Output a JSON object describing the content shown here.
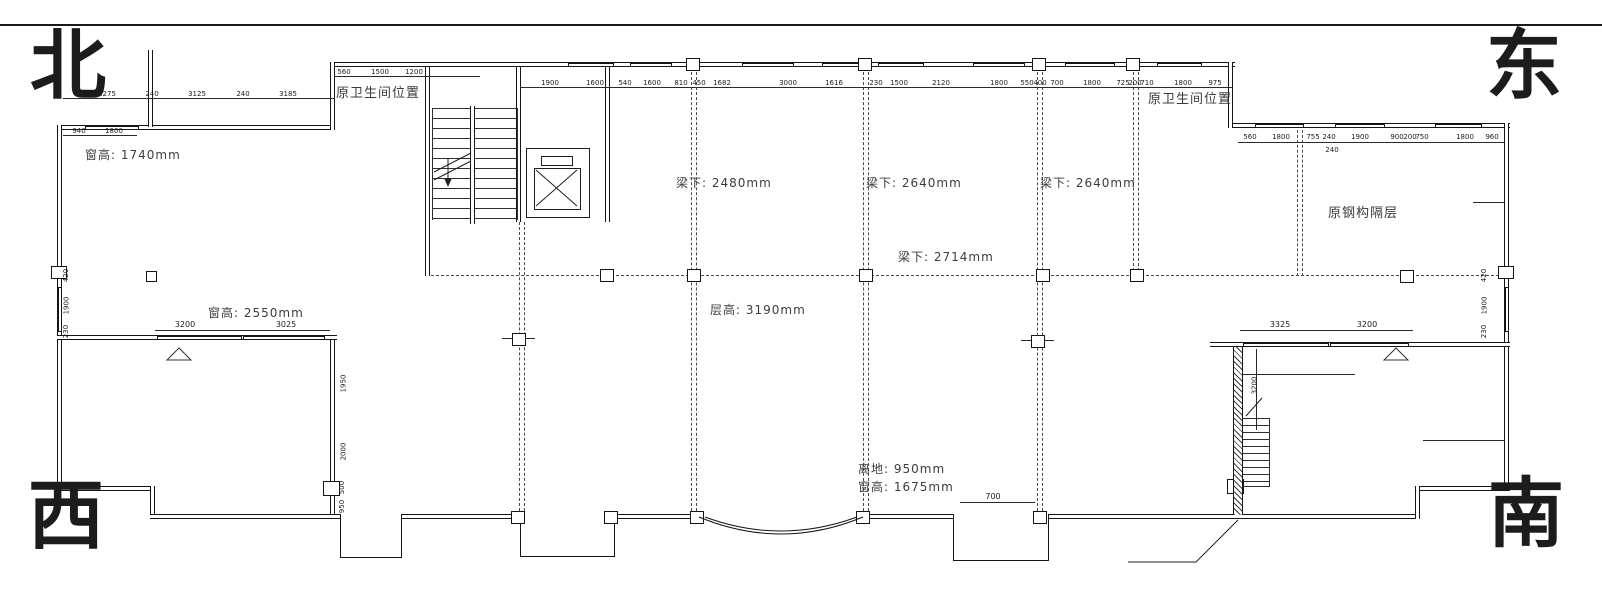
{
  "compass": {
    "north": "北",
    "east": "东",
    "west": "西",
    "south": "南"
  },
  "annotations": {
    "nw_window_height": "窗高: 1740mm",
    "w_window_height": "窗高: 2550mm",
    "s_above_ground": "离地: 950mm",
    "s_window_height": "窗高: 1675mm",
    "floor_height": "层高: 3190mm",
    "beam_a": "梁下: 2480mm",
    "beam_b": "梁下: 2640mm",
    "beam_c": "梁下: 2640mm",
    "beam_d": "梁下: 2714mm",
    "bathroom_nw": "原卫生间位置",
    "bathroom_ne": "原卫生间位置",
    "steel_mezzanine": "原钢构隔层"
  },
  "dims": {
    "nw_top": [
      "3275",
      "240",
      "3125",
      "240",
      "3185"
    ],
    "nw_window": [
      "940",
      "1800"
    ],
    "stair_top": [
      "560",
      "1500",
      "1200"
    ],
    "main_top": [
      "1900",
      "1600",
      "540",
      "1600",
      "810",
      "450",
      "1682",
      "3000",
      "1616",
      "230",
      "1500",
      "2120",
      "1800",
      "550",
      "400",
      "700",
      "1800",
      "725",
      "200",
      "710",
      "1800",
      "975"
    ],
    "east_top": [
      "560",
      "1800",
      "755",
      "240",
      "1900",
      "900",
      "200",
      "750",
      "1800",
      "960"
    ],
    "east_below": "240",
    "west_room_top": [
      "3200",
      "3025"
    ],
    "se_room_top": [
      "3325",
      "3200"
    ],
    "left_wall": [
      "420",
      "1900",
      "230"
    ],
    "right_wall": [
      "420",
      "1900",
      "230"
    ],
    "west_inner_wall": [
      "1950",
      "2000",
      "500",
      "950"
    ],
    "se_inner": "3200",
    "south_notch": "700"
  }
}
